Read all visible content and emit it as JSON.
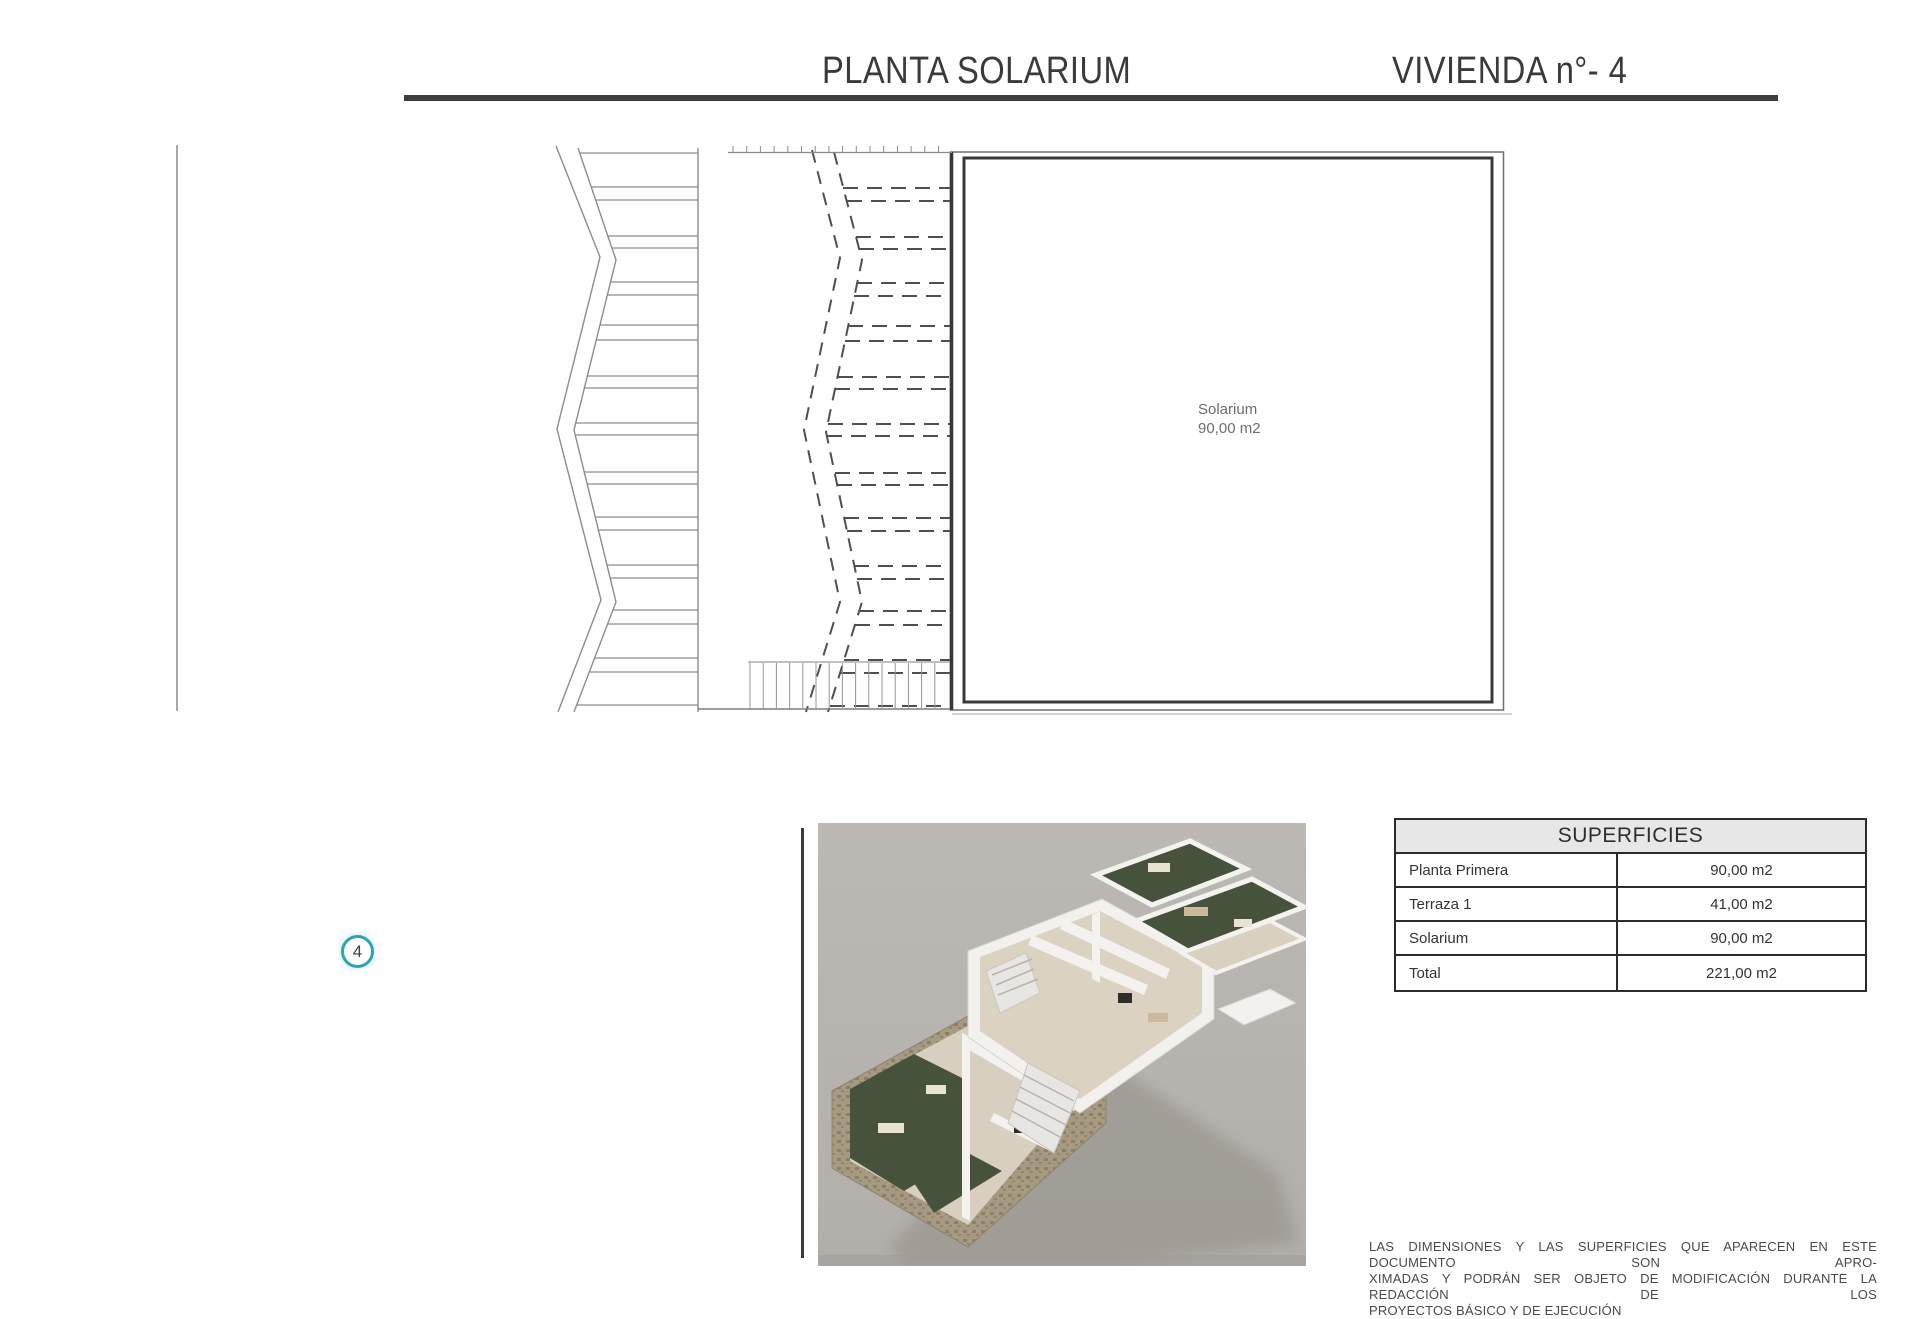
{
  "header": {
    "title_left": "PLANTA SOLARIUM",
    "title_right": "VIVIENDA n°- 4"
  },
  "plan": {
    "room_label": "Solarium",
    "room_area": "90,00 m2",
    "unit_marker": "4"
  },
  "superficies_table": {
    "title": "SUPERFICIES",
    "rows": [
      {
        "label": "Planta Primera",
        "value": "90,00 m2"
      },
      {
        "label": "Terraza 1",
        "value": "41,00 m2"
      },
      {
        "label": "Solarium",
        "value": "90,00 m2"
      },
      {
        "label": "Total",
        "value": "221,00 m2"
      }
    ]
  },
  "disclaimer": {
    "line1": "LAS DIMENSIONES Y LAS SUPERFICIES QUE APARECEN EN ESTE DOCUMENTO SON APRO-",
    "line2": "XIMADAS Y PODRÁN SER OBJETO DE MODIFICACIÓN DURANTE LA REDACCIÓN DE LOS",
    "line3": "PROYECTOS BÁSICO Y DE EJECUCIÓN"
  },
  "colors": {
    "accent_circle": "#2fa3b5",
    "header_rule": "#3d3d3d",
    "table_header_bg": "#e7e7e7",
    "render_background": "#b6b2ad",
    "garden_green": "#46523c"
  }
}
